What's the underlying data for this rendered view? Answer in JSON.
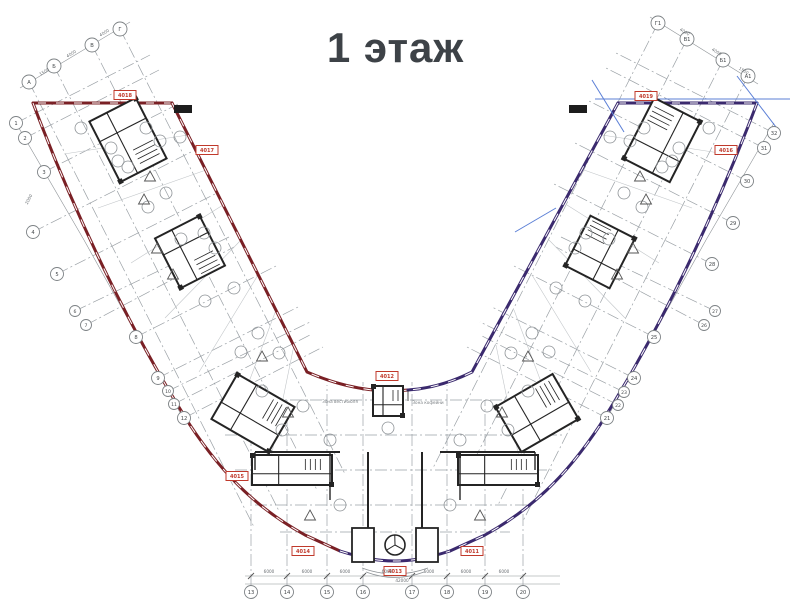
{
  "title": "1 этаж",
  "colors": {
    "left_wing_outline": "#7a2025",
    "right_wing_outline": "#3b2a6e",
    "construction_blue": "#5b7fd6",
    "marker_red": "#c0392b",
    "grid_gray": "#9ba1a6",
    "dim_gray": "#8d9296",
    "thin_gray": "#c2c6c9",
    "wall_black": "#242424",
    "text_gray": "#6a6f73",
    "title_gray": "#3d4247"
  },
  "grid": {
    "bubbles": [
      {
        "label": "А",
        "x": 29,
        "y": 82,
        "r": 7
      },
      {
        "label": "Б",
        "x": 54,
        "y": 66,
        "r": 7
      },
      {
        "label": "В",
        "x": 92,
        "y": 45,
        "r": 7
      },
      {
        "label": "Г",
        "x": 120,
        "y": 29,
        "r": 7
      },
      {
        "label": "Г1",
        "x": 658,
        "y": 23,
        "r": 7
      },
      {
        "label": "В1",
        "x": 687,
        "y": 39,
        "r": 7
      },
      {
        "label": "Б1",
        "x": 723,
        "y": 60,
        "r": 7
      },
      {
        "label": "А1",
        "x": 748,
        "y": 76,
        "r": 7
      },
      {
        "label": "1",
        "x": 16,
        "y": 123,
        "r": 6.5
      },
      {
        "label": "2",
        "x": 25,
        "y": 138,
        "r": 6.5
      },
      {
        "label": "3",
        "x": 44,
        "y": 172,
        "r": 6.5
      },
      {
        "label": "4",
        "x": 33,
        "y": 232,
        "r": 6.5
      },
      {
        "label": "5",
        "x": 57,
        "y": 274,
        "r": 6.5
      },
      {
        "label": "6",
        "x": 75,
        "y": 311,
        "r": 5.5
      },
      {
        "label": "7",
        "x": 86,
        "y": 325,
        "r": 5.5
      },
      {
        "label": "8",
        "x": 136,
        "y": 337,
        "r": 6.5
      },
      {
        "label": "9",
        "x": 158,
        "y": 378,
        "r": 6.5
      },
      {
        "label": "10",
        "x": 168,
        "y": 391,
        "r": 5.5
      },
      {
        "label": "11",
        "x": 174,
        "y": 404,
        "r": 5.5
      },
      {
        "label": "12",
        "x": 184,
        "y": 418,
        "r": 6.5
      },
      {
        "label": "13",
        "x": 251,
        "y": 592,
        "r": 6.5
      },
      {
        "label": "14",
        "x": 287,
        "y": 592,
        "r": 6.5
      },
      {
        "label": "15",
        "x": 327,
        "y": 592,
        "r": 6.5
      },
      {
        "label": "16",
        "x": 363,
        "y": 592,
        "r": 6.5
      },
      {
        "label": "17",
        "x": 412,
        "y": 592,
        "r": 6.5
      },
      {
        "label": "18",
        "x": 447,
        "y": 592,
        "r": 6.5
      },
      {
        "label": "19",
        "x": 485,
        "y": 592,
        "r": 6.5
      },
      {
        "label": "20",
        "x": 523,
        "y": 592,
        "r": 6.5
      },
      {
        "label": "21",
        "x": 607,
        "y": 418,
        "r": 6.5
      },
      {
        "label": "22",
        "x": 618,
        "y": 405,
        "r": 5.5
      },
      {
        "label": "23",
        "x": 624,
        "y": 392,
        "r": 5.5
      },
      {
        "label": "24",
        "x": 634,
        "y": 378,
        "r": 6.5
      },
      {
        "label": "25",
        "x": 654,
        "y": 337,
        "r": 6.5
      },
      {
        "label": "26",
        "x": 704,
        "y": 325,
        "r": 5.5
      },
      {
        "label": "27",
        "x": 715,
        "y": 311,
        "r": 5.5
      },
      {
        "label": "28",
        "x": 712,
        "y": 264,
        "r": 6.5
      },
      {
        "label": "29",
        "x": 733,
        "y": 223,
        "r": 6.5
      },
      {
        "label": "30",
        "x": 747,
        "y": 181,
        "r": 6.5
      },
      {
        "label": "31",
        "x": 764,
        "y": 148,
        "r": 6.5
      },
      {
        "label": "32",
        "x": 774,
        "y": 133,
        "r": 6.5
      }
    ],
    "axis_lines": [
      [
        29,
        82,
        254,
        527
      ],
      [
        54,
        66,
        279,
        511
      ],
      [
        92,
        45,
        317,
        490
      ],
      [
        120,
        29,
        345,
        474
      ],
      [
        658,
        23,
        433,
        468
      ],
      [
        687,
        39,
        462,
        484
      ],
      [
        723,
        60,
        498,
        505
      ],
      [
        748,
        76,
        523,
        521
      ],
      [
        16,
        123,
        150,
        55
      ],
      [
        25,
        138,
        159,
        70
      ],
      [
        44,
        172,
        178,
        104
      ],
      [
        33,
        232,
        193,
        151
      ],
      [
        57,
        274,
        217,
        193
      ],
      [
        75,
        311,
        229,
        237
      ],
      [
        86,
        325,
        234,
        247
      ],
      [
        136,
        337,
        276,
        266
      ],
      [
        158,
        378,
        298,
        307
      ],
      [
        168,
        391,
        310,
        322
      ],
      [
        174,
        404,
        310,
        335
      ],
      [
        184,
        418,
        323,
        347
      ],
      [
        607,
        418,
        467,
        347
      ],
      [
        618,
        405,
        480,
        335
      ],
      [
        624,
        392,
        480,
        322
      ],
      [
        634,
        378,
        492,
        307
      ],
      [
        654,
        337,
        514,
        266
      ],
      [
        704,
        325,
        556,
        247
      ],
      [
        715,
        311,
        561,
        237
      ],
      [
        712,
        264,
        552,
        183
      ],
      [
        733,
        223,
        573,
        142
      ],
      [
        747,
        181,
        587,
        100
      ],
      [
        764,
        148,
        604,
        67
      ],
      [
        774,
        133,
        614,
        52
      ],
      [
        251,
        586,
        251,
        430
      ],
      [
        287,
        586,
        287,
        400
      ],
      [
        327,
        586,
        327,
        385
      ],
      [
        363,
        586,
        363,
        382
      ],
      [
        412,
        586,
        412,
        382
      ],
      [
        447,
        586,
        447,
        385
      ],
      [
        485,
        586,
        485,
        400
      ],
      [
        523,
        586,
        523,
        430
      ],
      [
        230,
        400,
        560,
        400
      ],
      [
        225,
        435,
        565,
        435
      ],
      [
        235,
        470,
        555,
        470
      ],
      [
        255,
        505,
        535,
        505
      ],
      [
        280,
        532,
        510,
        532
      ]
    ],
    "dim_lines": [
      [
        16,
        123,
        84,
        240
      ],
      [
        84,
        240,
        183,
        418
      ],
      [
        774,
        123,
        706,
        240
      ],
      [
        706,
        240,
        607,
        418
      ],
      [
        20,
        88,
        130,
        22
      ],
      [
        650,
        17,
        758,
        84
      ],
      [
        245,
        576,
        560,
        576
      ],
      [
        245,
        584,
        560,
        584
      ]
    ],
    "partition_lines": [
      [
        64,
        154,
        188,
        135
      ],
      [
        98,
        208,
        206,
        170
      ],
      [
        131,
        263,
        223,
        205
      ],
      [
        165,
        318,
        241,
        240
      ],
      [
        199,
        372,
        258,
        275
      ],
      [
        232,
        427,
        276,
        310
      ],
      [
        266,
        482,
        294,
        345
      ],
      [
        726,
        154,
        602,
        135
      ],
      [
        692,
        208,
        584,
        170
      ],
      [
        659,
        263,
        567,
        205
      ],
      [
        625,
        318,
        549,
        240
      ],
      [
        591,
        372,
        532,
        275
      ],
      [
        558,
        427,
        514,
        310
      ],
      [
        524,
        482,
        496,
        345
      ]
    ]
  },
  "outline": {
    "red_paths": [
      "M 172,103 L 33,103",
      "M 33,103 C 75,215 130,330 190,425 C 225,478 260,510 305,535 L 340,551",
      "M 172,103 L 307,372 Q 360,395 408,390"
    ],
    "purple_paths": [
      "M 618,103 L 757,103",
      "M 757,103 C 715,215 660,330 600,425 C 565,478 530,510 485,535 L 450,551",
      "M 618,103 L 472,372 Q 440,388 408,390",
      "M 340,551 C 365,559 380,561 395,561 C 410,561 425,559 450,551"
    ],
    "blue_lines": [
      [
        595,
        99,
        790,
        99
      ],
      [
        737,
        76,
        779,
        131
      ],
      [
        592,
        80,
        624,
        132
      ],
      [
        515,
        232,
        556,
        208
      ]
    ]
  },
  "cores": [
    {
      "cx": 128,
      "cy": 140,
      "w": 68,
      "h": 52,
      "rot": 63
    },
    {
      "cx": 190,
      "cy": 252,
      "w": 56,
      "h": 50,
      "rot": 63
    },
    {
      "cx": 253,
      "cy": 413,
      "w": 66,
      "h": 52,
      "rot": 30
    },
    {
      "cx": 292,
      "cy": 470,
      "w": 80,
      "h": 30,
      "rot": 0
    },
    {
      "cx": 388,
      "cy": 401,
      "w": 30,
      "h": 30,
      "rot": 0
    },
    {
      "cx": 498,
      "cy": 470,
      "w": 80,
      "h": 30,
      "rot": 0
    },
    {
      "cx": 537,
      "cy": 413,
      "w": 66,
      "h": 52,
      "rot": -30
    },
    {
      "cx": 600,
      "cy": 252,
      "w": 56,
      "h": 50,
      "rot": -63
    },
    {
      "cx": 662,
      "cy": 140,
      "w": 68,
      "h": 52,
      "rot": -63
    }
  ],
  "walls": [
    [
      255,
      452,
      340,
      452,
      2
    ],
    [
      440,
      452,
      535,
      452,
      2
    ],
    [
      368,
      452,
      368,
      528,
      2
    ],
    [
      422,
      452,
      422,
      528,
      2
    ],
    [
      330,
      452,
      330,
      500,
      1.4
    ],
    [
      460,
      452,
      460,
      500,
      1.4
    ],
    [
      255,
      452,
      255,
      470,
      1.4
    ],
    [
      535,
      452,
      535,
      470,
      1.4
    ]
  ],
  "entrance": {
    "boxes": [
      [
        352,
        528,
        22,
        34
      ],
      [
        416,
        528,
        22,
        34
      ]
    ],
    "door_circle": {
      "cx": 395,
      "cy": 545,
      "r": 10
    },
    "steps": [
      "M 362,568 Q 395,580 428,568",
      "M 366,572 Q 395,583 424,572"
    ]
  },
  "room_circles": [
    [
      81,
      128
    ],
    [
      111,
      148
    ],
    [
      118,
      161
    ],
    [
      128,
      167
    ],
    [
      146,
      128
    ],
    [
      160,
      141
    ],
    [
      180,
      137
    ],
    [
      166,
      193
    ],
    [
      148,
      207
    ],
    [
      181,
      239
    ],
    [
      204,
      233
    ],
    [
      215,
      248
    ],
    [
      234,
      288
    ],
    [
      205,
      301
    ],
    [
      258,
      333
    ],
    [
      241,
      352
    ],
    [
      279,
      353
    ],
    [
      262,
      391
    ],
    [
      303,
      406
    ],
    [
      282,
      430
    ],
    [
      388,
      428
    ],
    [
      330,
      440
    ],
    [
      460,
      440
    ],
    [
      340,
      505
    ],
    [
      450,
      505
    ],
    [
      709,
      128
    ],
    [
      679,
      148
    ],
    [
      672,
      161
    ],
    [
      662,
      167
    ],
    [
      644,
      128
    ],
    [
      630,
      141
    ],
    [
      610,
      137
    ],
    [
      624,
      193
    ],
    [
      642,
      207
    ],
    [
      609,
      239
    ],
    [
      586,
      233
    ],
    [
      575,
      248
    ],
    [
      556,
      288
    ],
    [
      585,
      301
    ],
    [
      532,
      333
    ],
    [
      549,
      352
    ],
    [
      511,
      353
    ],
    [
      528,
      391
    ],
    [
      487,
      406
    ],
    [
      508,
      430
    ]
  ],
  "triangles": [
    [
      150,
      177
    ],
    [
      144,
      200
    ],
    [
      157,
      249
    ],
    [
      173,
      275
    ],
    [
      262,
      357
    ],
    [
      288,
      413
    ],
    [
      310,
      516
    ],
    [
      480,
      516
    ],
    [
      502,
      413
    ],
    [
      528,
      357
    ],
    [
      617,
      275
    ],
    [
      633,
      249
    ],
    [
      646,
      200
    ],
    [
      640,
      177
    ]
  ],
  "markers": [
    {
      "label": "4018",
      "x": 125,
      "y": 95,
      "type": "red"
    },
    {
      "label": "4017",
      "x": 207,
      "y": 150,
      "type": "red"
    },
    {
      "label": "4019",
      "x": 646,
      "y": 96,
      "type": "red"
    },
    {
      "label": "4016",
      "x": 726,
      "y": 150,
      "type": "red"
    },
    {
      "label": "4015",
      "x": 237,
      "y": 476,
      "type": "red"
    },
    {
      "label": "4014",
      "x": 303,
      "y": 551,
      "type": "red"
    },
    {
      "label": "4012",
      "x": 387,
      "y": 376,
      "type": "red"
    },
    {
      "label": "4013",
      "x": 395,
      "y": 571,
      "type": "red"
    },
    {
      "label": "4011",
      "x": 472,
      "y": 551,
      "type": "red"
    },
    {
      "label": "",
      "x": 183,
      "y": 109,
      "type": "black"
    },
    {
      "label": "",
      "x": 578,
      "y": 109,
      "type": "black"
    }
  ],
  "zones": [
    {
      "text": "Зона вестибюля",
      "x": 340,
      "y": 403
    },
    {
      "text": "Зона кофейни",
      "x": 428,
      "y": 404
    }
  ],
  "dimensions": [
    {
      "text": "6000",
      "x": 269,
      "y": 573,
      "rot": 0
    },
    {
      "text": "6000",
      "x": 307,
      "y": 573,
      "rot": 0
    },
    {
      "text": "6000",
      "x": 345,
      "y": 573,
      "rot": 0
    },
    {
      "text": "6000",
      "x": 387,
      "y": 573,
      "rot": 0
    },
    {
      "text": "6000",
      "x": 429,
      "y": 573,
      "rot": 0
    },
    {
      "text": "6000",
      "x": 466,
      "y": 573,
      "rot": 0
    },
    {
      "text": "6000",
      "x": 504,
      "y": 573,
      "rot": 0
    },
    {
      "text": "42000",
      "x": 402,
      "y": 582,
      "rot": 0
    },
    {
      "text": "1500",
      "x": 45,
      "y": 73,
      "rot": -31
    },
    {
      "text": "4000",
      "x": 72,
      "y": 55,
      "rot": -31
    },
    {
      "text": "4000",
      "x": 105,
      "y": 34,
      "rot": -31
    },
    {
      "text": "4000",
      "x": 684,
      "y": 33,
      "rot": 31
    },
    {
      "text": "4000",
      "x": 716,
      "y": 53,
      "rot": 31
    },
    {
      "text": "1500",
      "x": 743,
      "y": 72,
      "rot": 31
    },
    {
      "text": "2000",
      "x": 30,
      "y": 200,
      "rot": -62
    }
  ]
}
